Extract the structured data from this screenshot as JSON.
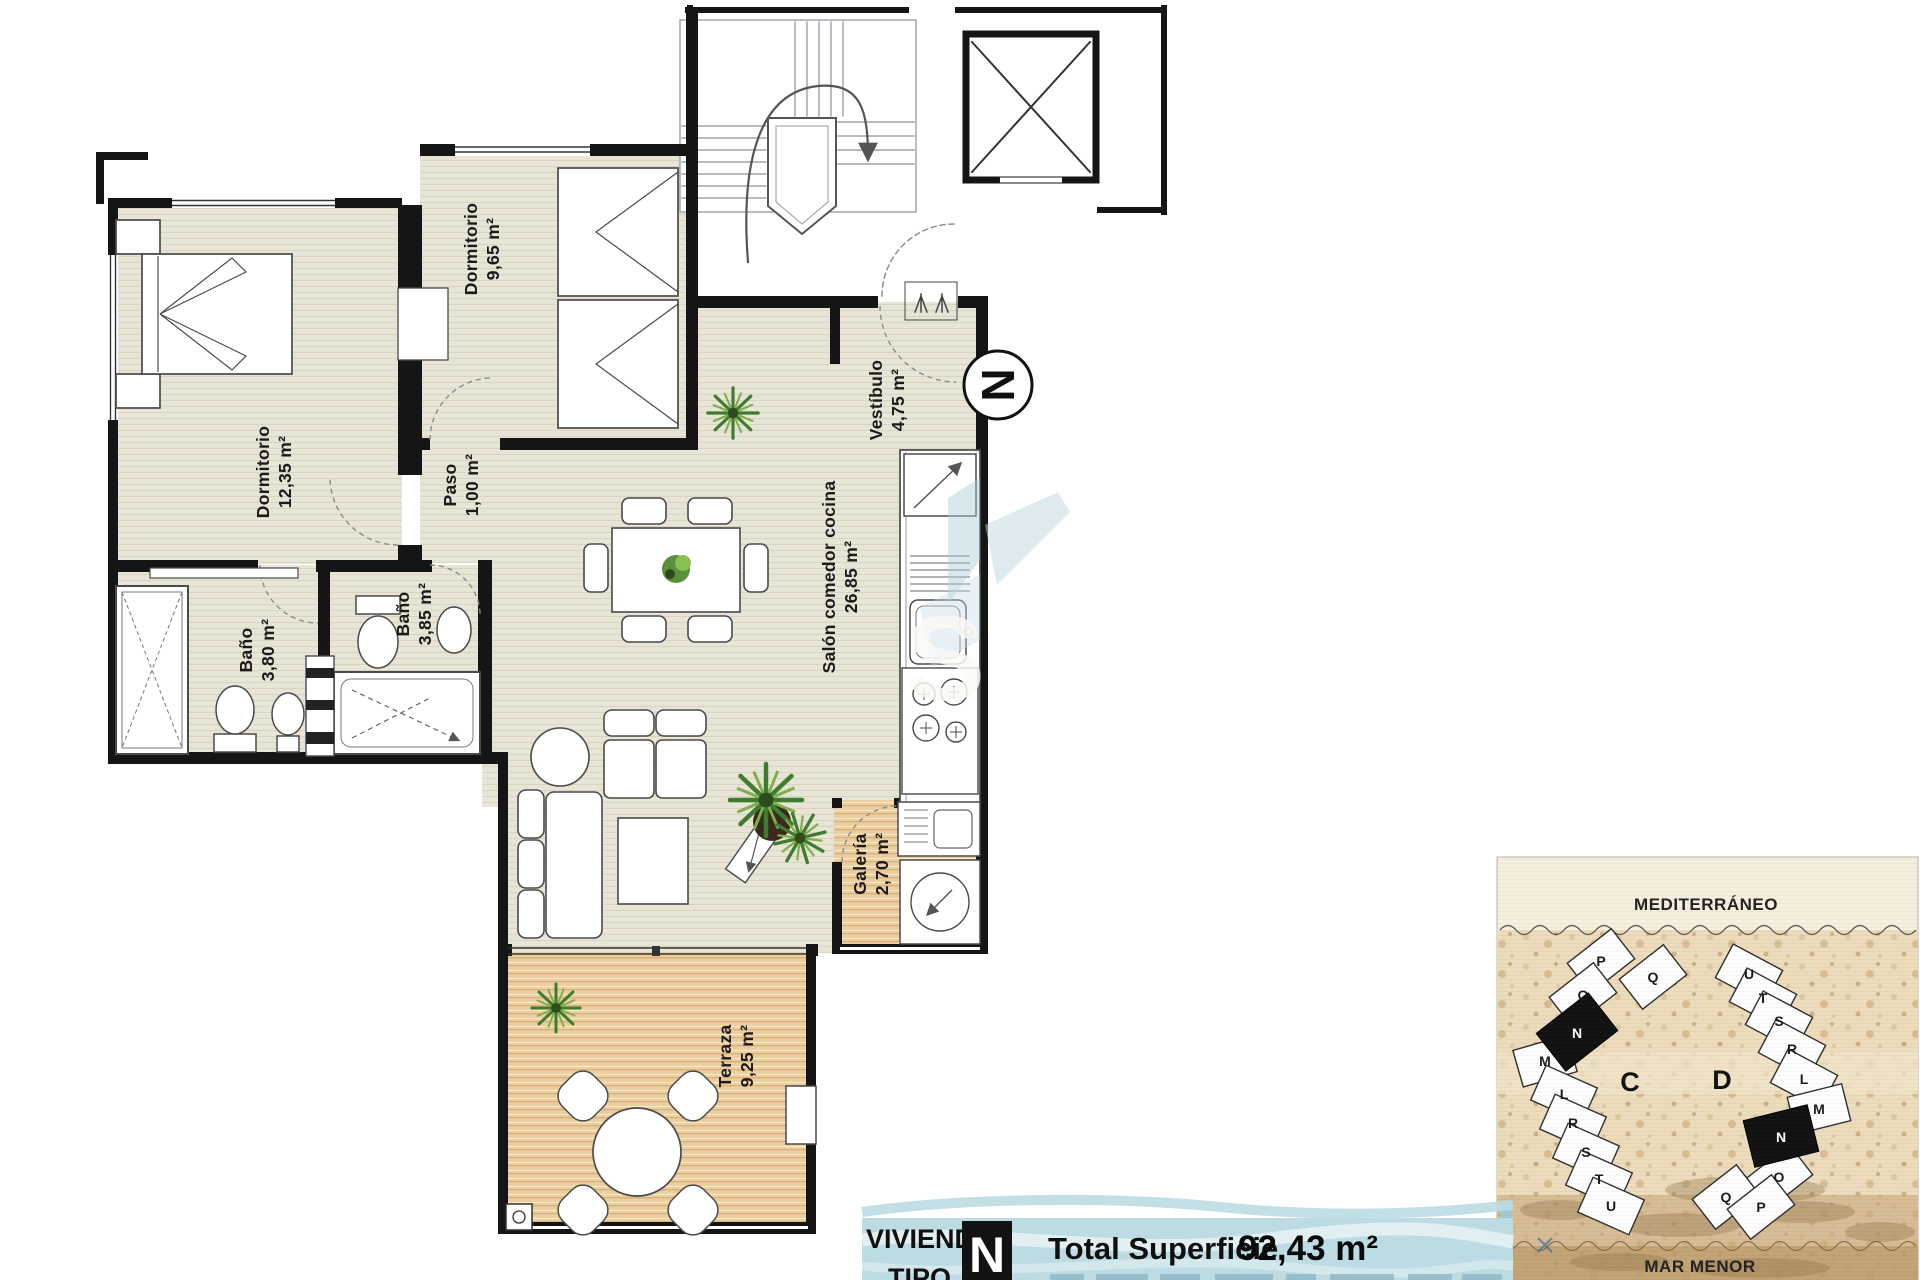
{
  "plan": {
    "north_label": "N",
    "watermark_letter": "S",
    "rooms": [
      {
        "id": "dormitorio-1",
        "name": "Dormitorio",
        "area": "12,35 m²"
      },
      {
        "id": "dormitorio-2",
        "name": "Dormitorio",
        "area": "9,65 m²"
      },
      {
        "id": "paso",
        "name": "Paso",
        "area": "1,00 m²"
      },
      {
        "id": "bano-1",
        "name": "Baño",
        "area": "3,80 m²"
      },
      {
        "id": "bano-2",
        "name": "Baño",
        "area": "3,85 m²"
      },
      {
        "id": "salon",
        "name": "Salón comedor cocina",
        "area": "26,85 m²"
      },
      {
        "id": "vestibulo",
        "name": "Vestíbulo",
        "area": "4,75 m²"
      },
      {
        "id": "galeria",
        "name": "Galería",
        "area": "2,70 m²"
      },
      {
        "id": "terraza",
        "name": "Terraza",
        "area": "9,25 m²"
      }
    ]
  },
  "title_block": {
    "label_line1": "VIVIENDA",
    "label_line2": "TIPO",
    "type_letter": "N",
    "total_label": "Total Superficie",
    "total_value": "92,43 m²"
  },
  "site_map": {
    "sea_label": "MEDITERRÁNEO",
    "lagoon_label": "MAR MENOR",
    "blocks": [
      {
        "label": "C",
        "units": [
          "P",
          "Q",
          "O",
          "N",
          "M",
          "L",
          "R",
          "S",
          "T",
          "U"
        ],
        "highlighted_unit": "N"
      },
      {
        "label": "D",
        "units": [
          "U",
          "T",
          "S",
          "R",
          "L",
          "M",
          "N",
          "O",
          "Q",
          "P"
        ],
        "highlighted_unit": "N"
      }
    ]
  },
  "colors": {
    "floor_beige": "#e8e4d6",
    "floor_wood": "#eccfa0",
    "wall": "#151515",
    "title_block_blue": "#bcdbe3",
    "sand": "#ecdcbc",
    "highlight_black": "#121212"
  }
}
